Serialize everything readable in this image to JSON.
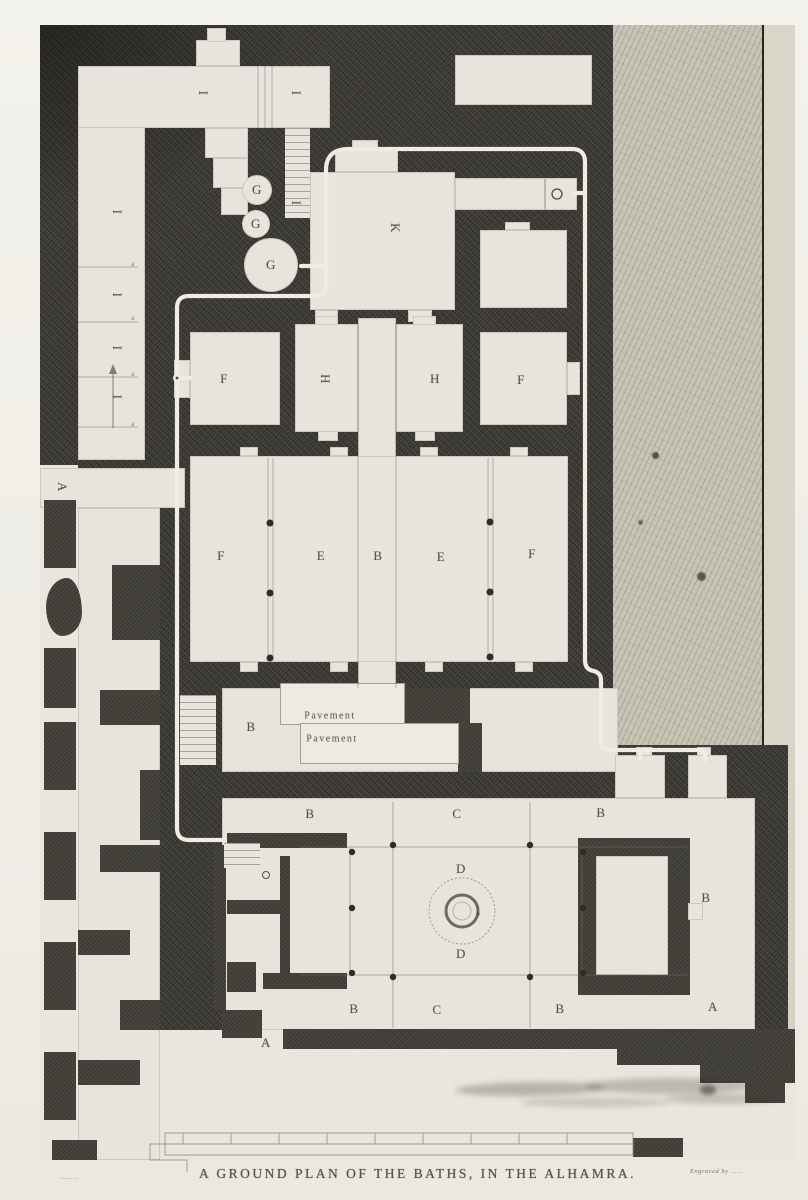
{
  "plate": {
    "caption": "A GROUND PLAN OF THE BATHS, IN THE ALHAMRA.",
    "credit_left": "………",
    "credit_right": "Engraved by ……"
  },
  "colors": {
    "plate_dark": "#3b3934",
    "room_light": "#e7e5db",
    "garden_hatch": "#c9c5b6",
    "pipe_white": "#efede3",
    "paper": "#f2f0ea"
  },
  "plan_labels": [
    {
      "t": "I",
      "x": 203,
      "y": 93,
      "rot": 90
    },
    {
      "t": "I",
      "x": 296,
      "y": 93,
      "rot": 90
    },
    {
      "t": "I",
      "x": 296,
      "y": 203,
      "rot": 90
    },
    {
      "t": "I",
      "x": 117,
      "y": 212,
      "rot": 90
    },
    {
      "t": "I",
      "x": 117,
      "y": 295,
      "rot": 90
    },
    {
      "t": "I",
      "x": 117,
      "y": 348,
      "rot": 90
    },
    {
      "t": "I",
      "x": 117,
      "y": 397,
      "rot": 90
    },
    {
      "t": "a",
      "x": 133,
      "y": 264,
      "cls": "tiny"
    },
    {
      "t": "a",
      "x": 133,
      "y": 318,
      "cls": "tiny"
    },
    {
      "t": "a",
      "x": 133,
      "y": 374,
      "cls": "tiny"
    },
    {
      "t": "a",
      "x": 133,
      "y": 424,
      "cls": "tiny"
    },
    {
      "t": "G",
      "x": 257,
      "y": 190
    },
    {
      "t": "G",
      "x": 256,
      "y": 224
    },
    {
      "t": "G",
      "x": 271,
      "y": 265
    },
    {
      "t": "K",
      "x": 395,
      "y": 228,
      "rot": 90
    },
    {
      "t": "F",
      "x": 224,
      "y": 379
    },
    {
      "t": "H",
      "x": 325,
      "y": 379,
      "rot": 90
    },
    {
      "t": "H",
      "x": 435,
      "y": 379
    },
    {
      "t": "F",
      "x": 521,
      "y": 380
    },
    {
      "t": "F",
      "x": 221,
      "y": 556
    },
    {
      "t": "E",
      "x": 321,
      "y": 556
    },
    {
      "t": "B",
      "x": 378,
      "y": 556
    },
    {
      "t": "E",
      "x": 441,
      "y": 557
    },
    {
      "t": "F",
      "x": 532,
      "y": 554
    },
    {
      "t": "B",
      "x": 251,
      "y": 727
    },
    {
      "t": "Pavement",
      "x": 330,
      "y": 716,
      "cls": "pav"
    },
    {
      "t": "Pavement",
      "x": 332,
      "y": 739,
      "cls": "pav"
    },
    {
      "t": "B",
      "x": 310,
      "y": 814
    },
    {
      "t": "C",
      "x": 457,
      "y": 814
    },
    {
      "t": "B",
      "x": 601,
      "y": 813
    },
    {
      "t": "D",
      "x": 461,
      "y": 869
    },
    {
      "t": "D",
      "x": 461,
      "y": 954
    },
    {
      "t": "B",
      "x": 706,
      "y": 898
    },
    {
      "t": "B",
      "x": 354,
      "y": 1009
    },
    {
      "t": "C",
      "x": 437,
      "y": 1010
    },
    {
      "t": "B",
      "x": 560,
      "y": 1009
    },
    {
      "t": "A",
      "x": 62,
      "y": 487,
      "rot": 90
    },
    {
      "t": "A",
      "x": 266,
      "y": 1043
    },
    {
      "t": "A",
      "x": 713,
      "y": 1007
    }
  ]
}
